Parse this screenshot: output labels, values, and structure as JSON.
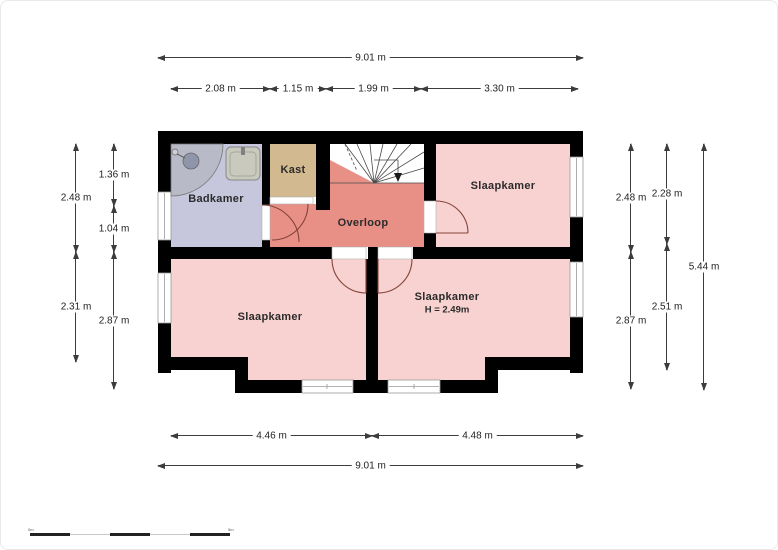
{
  "plan": {
    "rooms": {
      "badkamer": {
        "label": "Badkamer"
      },
      "kast": {
        "label": "Kast"
      },
      "overloop": {
        "label": "Overloop"
      },
      "slaapkamer_top_right": {
        "label": "Slaapkamer"
      },
      "slaapkamer_bottom_left": {
        "label": "Slaapkamer"
      },
      "slaapkamer_bottom_right": {
        "label": "Slaapkamer",
        "height_note": "H = 2.49m"
      }
    },
    "colors": {
      "wall": "#000000",
      "bedroom_fill": "#f8d2d0",
      "hall_fill": "#e89086",
      "bathroom_fill": "#c6c6dd",
      "closet_fill": "#d3b98f",
      "stairs_fill": "#ffffff",
      "door_arc": "#83443a"
    }
  },
  "dimensions": {
    "top_total": "9.01 m",
    "top_segments": [
      "2.08 m",
      "1.15 m",
      "1.99 m",
      "3.30 m"
    ],
    "left_outer": [
      "2.48 m",
      "2.31 m"
    ],
    "left_inner": [
      "1.36 m",
      "1.04 m",
      "2.87 m"
    ],
    "right_inner": [
      "2.48 m",
      "2.87 m"
    ],
    "right_middle": [
      "2.28 m",
      "2.51 m"
    ],
    "right_total": "5.44 m",
    "bottom_segments": [
      "4.46 m",
      "4.48 m"
    ],
    "bottom_total": "9.01 m"
  },
  "scale_bar": {
    "start": "0m",
    "end": "5m"
  }
}
